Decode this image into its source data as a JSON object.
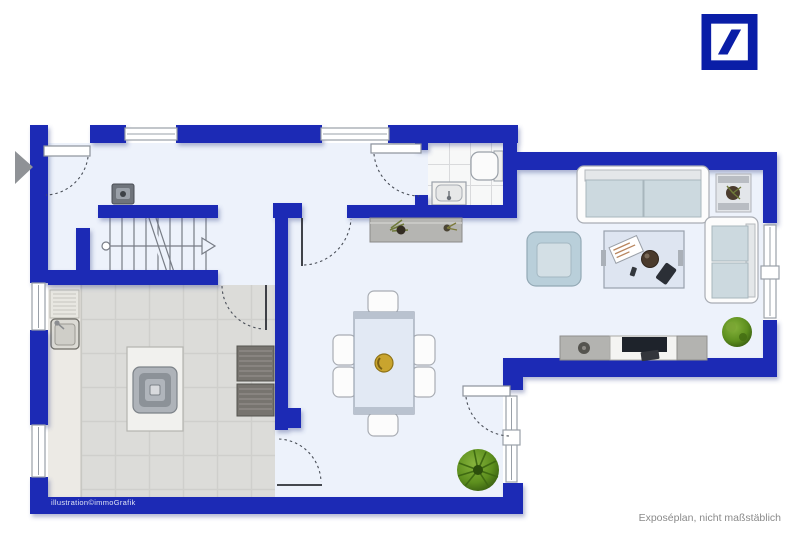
{
  "texts": {
    "credit": "illustration©immoGrafik",
    "disclaimer": "Exposéplan, nicht maßstäblich"
  },
  "icons": {
    "logo": "deutsche-bank-slash-logo",
    "entrance_marker": "entrance-direction-arrow",
    "stair_direction": "stair-walk-line-arrow"
  },
  "colors": {
    "wall": "#1a2cb5",
    "floor": "#edf2fb",
    "kitchen_floor": "#dcdcd9",
    "kitchen_grid": "#cfcfcc",
    "kitchen_counter": "#eceae5",
    "bath_floor": "#f7f8f8",
    "bath_grid": "#d9dadc",
    "furniture_white": "#fcfcfc",
    "furniture_stroke": "#a9adb4",
    "cushion": "#ccd9df",
    "armchair": "#b9cfda",
    "table_blue": "#e2e9f4",
    "gray_furniture": "#b3b3b0",
    "dark_counter": "#77746f",
    "plant_green": "#5d8f1e",
    "logo_blue": "#0a1ea7",
    "disclaimer_text": "#8a8a8a",
    "credit_text": "#dfe4f5"
  }
}
